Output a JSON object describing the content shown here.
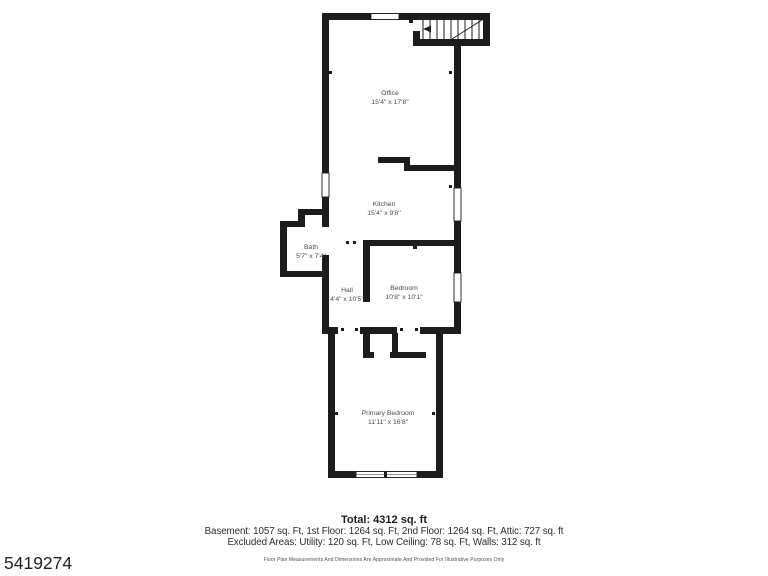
{
  "plan": {
    "wall_color": "#1c1c1c",
    "label_color": "#4a4a4a",
    "rooms": [
      {
        "name": "Office",
        "dims": "15'4\" x 17'8\""
      },
      {
        "name": "Kitchen",
        "dims": "15'4\" x 9'8\""
      },
      {
        "name": "Bath",
        "dims": "5'7\" x 7'4\""
      },
      {
        "name": "Hall",
        "dims": "4'4\" x 10'5\""
      },
      {
        "name": "Bedroom",
        "dims": "10'8\" x 10'1\""
      },
      {
        "name": "Primary Bedroom",
        "dims": "11'11\" x 16'8\""
      }
    ]
  },
  "footer": {
    "total": "Total: 4312 sq. ft",
    "levels": "Basement: 1057 sq. Ft, 1st Floor: 1264 sq. Ft, 2nd Floor: 1264 sq. Ft, Attic: 727 sq. ft",
    "excluded": "Excluded Areas: Utility: 120 sq. Ft, Low Ceiling: 78 sq. Ft, Walls: 312 sq. ft",
    "disclaimer": "Floor Plan Measurements And Dimensions Are Approximate And Provided For Illustrative Purposes Only"
  },
  "listing_id": "5419274"
}
